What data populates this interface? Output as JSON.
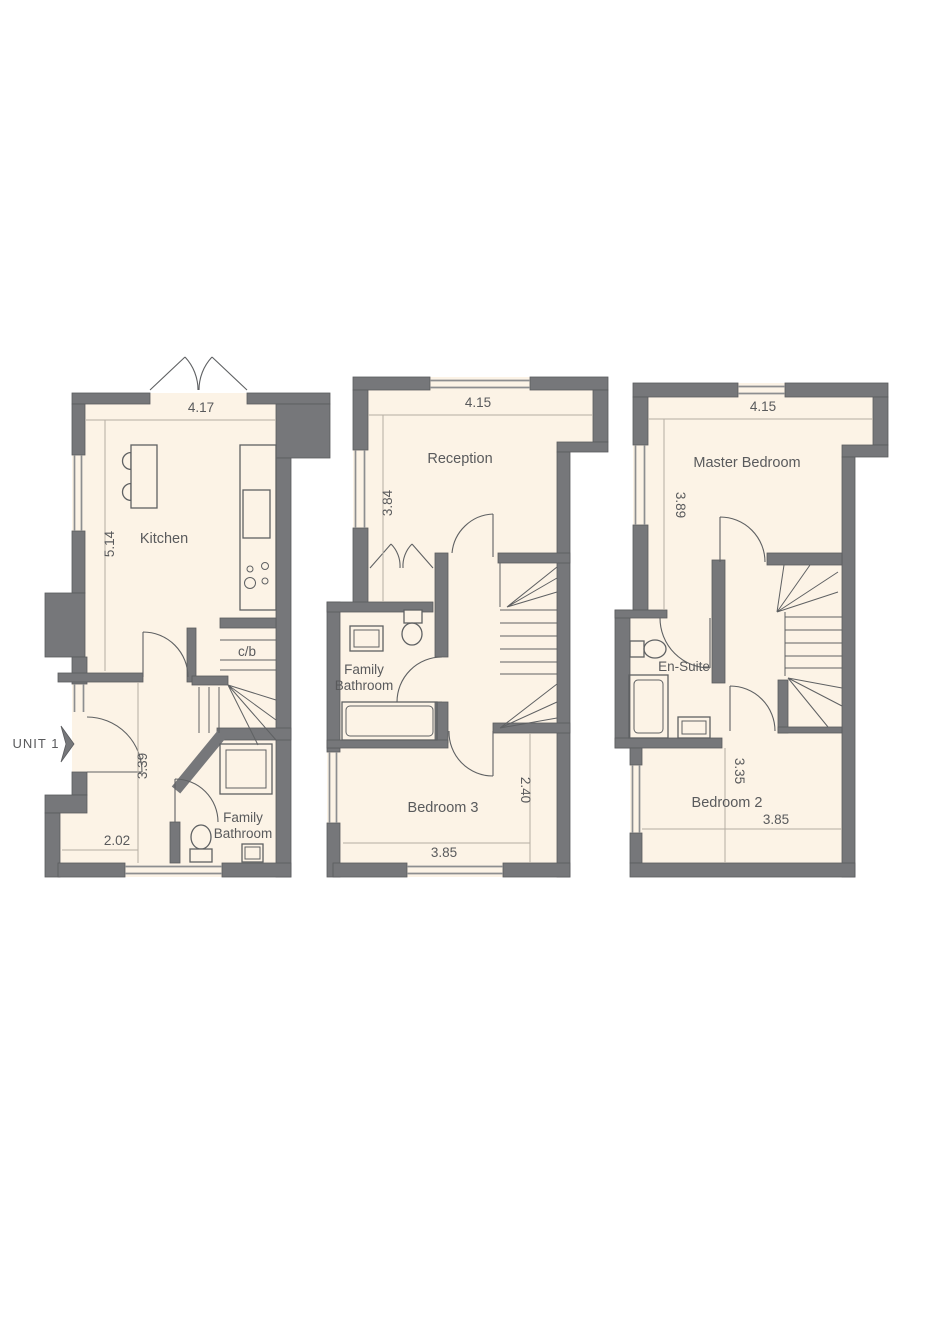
{
  "unit": {
    "label": "UNIT 1"
  },
  "colors": {
    "wall": "#76777a",
    "floor": "#fcf3e6",
    "fixture": "#5f6163",
    "dimline": "#b5aea3",
    "windowline": "#8d8e90",
    "text": "#595a5c"
  },
  "floors": {
    "ground": {
      "rooms": {
        "kitchen": "Kitchen",
        "cupboard": "c/b",
        "bathroom_line1": "Family",
        "bathroom_line2": "Bathroom"
      },
      "dims": {
        "kitchen_width": "4.17",
        "kitchen_depth": "5.14",
        "hall_depth": "3.39",
        "hall_width": "2.02"
      }
    },
    "first": {
      "rooms": {
        "reception": "Reception",
        "bathroom_line1": "Family",
        "bathroom_line2": "Bathroom",
        "bedroom": "Bedroom 3"
      },
      "dims": {
        "reception_width": "4.15",
        "reception_depth": "3.84",
        "bedroom_depth": "2.40",
        "bedroom_width": "3.85"
      }
    },
    "second": {
      "rooms": {
        "master": "Master Bedroom",
        "ensuite": "En-Suite",
        "bedroom": "Bedroom 2"
      },
      "dims": {
        "master_width": "4.15",
        "master_depth": "3.89",
        "bedroom_depth": "3.35",
        "bedroom_width": "3.85"
      }
    }
  }
}
